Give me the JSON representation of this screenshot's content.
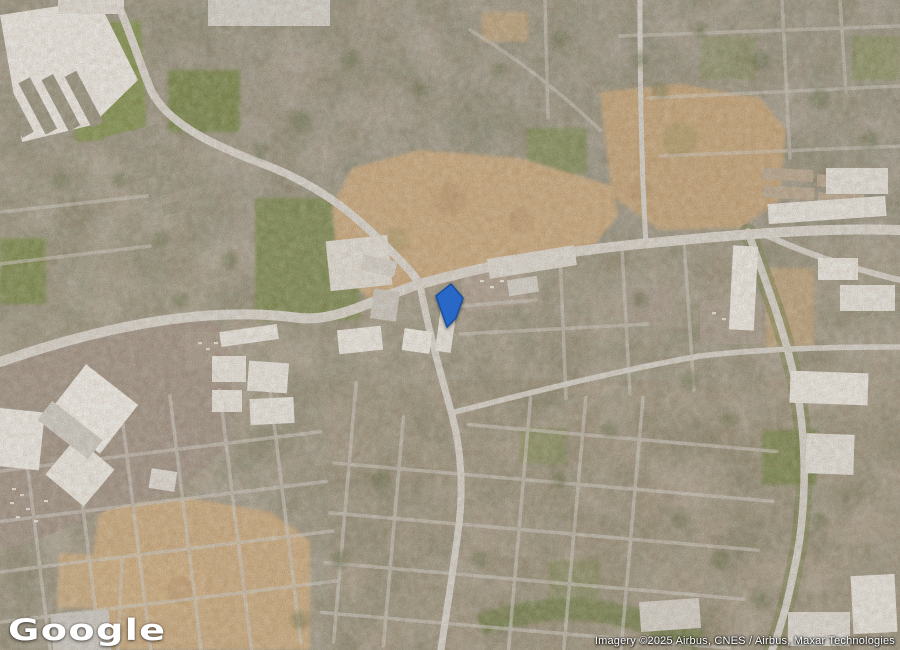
{
  "map": {
    "provider_logo": "Google",
    "attribution": "Imagery ©2025 Airbus, CNES / Airbus, Maxar Technologies",
    "view_type": "satellite",
    "marker": {
      "type": "parcel-highlight",
      "fill": "#2b67c8",
      "stroke": "#1a4f9e",
      "points": "451,284 463,298 456,318 447,327 436,296"
    },
    "palette": {
      "urban_base": "#aba496",
      "road": "#d4d1ca",
      "minor_road": "#c9c6bf",
      "dirt": "#c4a67c",
      "field_green": "#7d8a52",
      "tree_green": "#59653e",
      "parking": "#9d9184",
      "building_white": "#e9e7e1",
      "highway_green_edge": "#6f7d48"
    }
  }
}
